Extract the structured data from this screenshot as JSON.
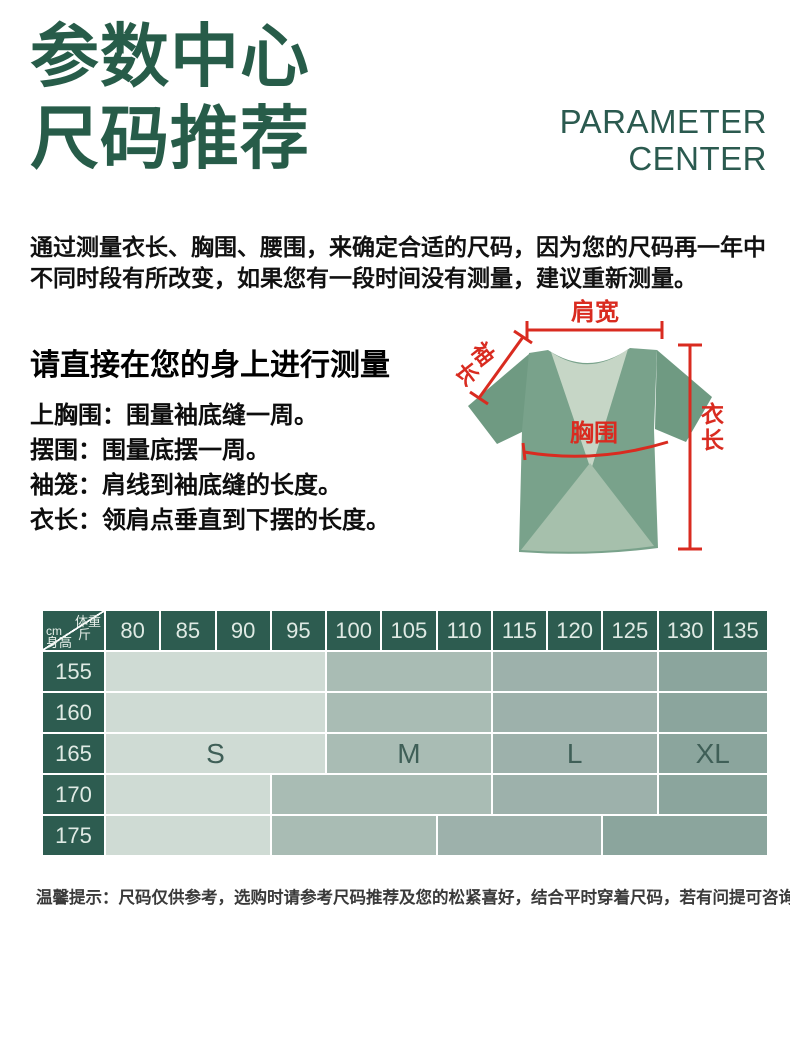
{
  "header": {
    "title_line1": "参数中心",
    "title_line2": "尺码推荐",
    "subtitle_line1": "PARAMETER",
    "subtitle_line2": "CENTER"
  },
  "intro": {
    "line1": "通过测量衣长、胸围、腰围，来确定合适的尺码，因为您的尺码再一年中",
    "line2": "不同时段有所改变，如果您有一段时间没有测量，建议重新测量。"
  },
  "measurement_guide": {
    "heading": "请直接在您的身上进行测量",
    "items": [
      "上胸围：围量袖底缝一周。",
      "摆围：围量底摆一周。",
      "袖笼：肩线到袖底缝的长度。",
      "衣长：领肩点垂直到下摆的长度。"
    ]
  },
  "diagram": {
    "shoulder_label": "肩宽",
    "sleeve_label": "袖长",
    "chest_label": "胸围",
    "length_label": "衣长",
    "annotation_color": "#d92b20",
    "shirt_color": "#79a28b"
  },
  "size_table": {
    "corner": {
      "axis_x_label": "体重",
      "axis_x_unit": "斤",
      "axis_y_unit": "cm",
      "axis_y_label": "身高"
    },
    "weight_columns": [
      "80",
      "85",
      "90",
      "95",
      "100",
      "105",
      "110",
      "115",
      "120",
      "125",
      "130",
      "135"
    ],
    "rows": [
      {
        "height": "155",
        "blocks": [
          {
            "size": "S",
            "span": 4,
            "show_label": false
          },
          {
            "size": "M",
            "span": 3,
            "show_label": false
          },
          {
            "size": "L",
            "span": 3,
            "show_label": false
          },
          {
            "size": "XL",
            "span": 2,
            "show_label": false
          }
        ]
      },
      {
        "height": "160",
        "blocks": [
          {
            "size": "S",
            "span": 4,
            "show_label": false
          },
          {
            "size": "M",
            "span": 3,
            "show_label": false
          },
          {
            "size": "L",
            "span": 3,
            "show_label": false
          },
          {
            "size": "XL",
            "span": 2,
            "show_label": false
          }
        ]
      },
      {
        "height": "165",
        "blocks": [
          {
            "size": "S",
            "span": 4,
            "show_label": true
          },
          {
            "size": "M",
            "span": 3,
            "show_label": true
          },
          {
            "size": "L",
            "span": 3,
            "show_label": true
          },
          {
            "size": "XL",
            "span": 2,
            "show_label": true
          }
        ]
      },
      {
        "height": "170",
        "blocks": [
          {
            "size": "S",
            "span": 3,
            "show_label": false
          },
          {
            "size": "M",
            "span": 4,
            "show_label": false
          },
          {
            "size": "L",
            "span": 3,
            "show_label": false
          },
          {
            "size": "XL",
            "span": 2,
            "show_label": false
          }
        ]
      },
      {
        "height": "175",
        "blocks": [
          {
            "size": "S",
            "span": 3,
            "show_label": false
          },
          {
            "size": "M",
            "span": 3,
            "show_label": false
          },
          {
            "size": "L",
            "span": 3,
            "show_label": false
          },
          {
            "size": "XL",
            "span": 3,
            "show_label": false
          }
        ]
      }
    ],
    "size_colors": {
      "S": "#cfdbd4",
      "M": "#a9bcb4",
      "L": "#9db1ab",
      "XL": "#8ba59d"
    },
    "header_color": "#2d5c50"
  },
  "footer_note": "温馨提示：尺码仅供参考，选购时请参考尺码推荐及您的松紧喜好，结合平时穿着尺码，若有问提可咨询客服"
}
